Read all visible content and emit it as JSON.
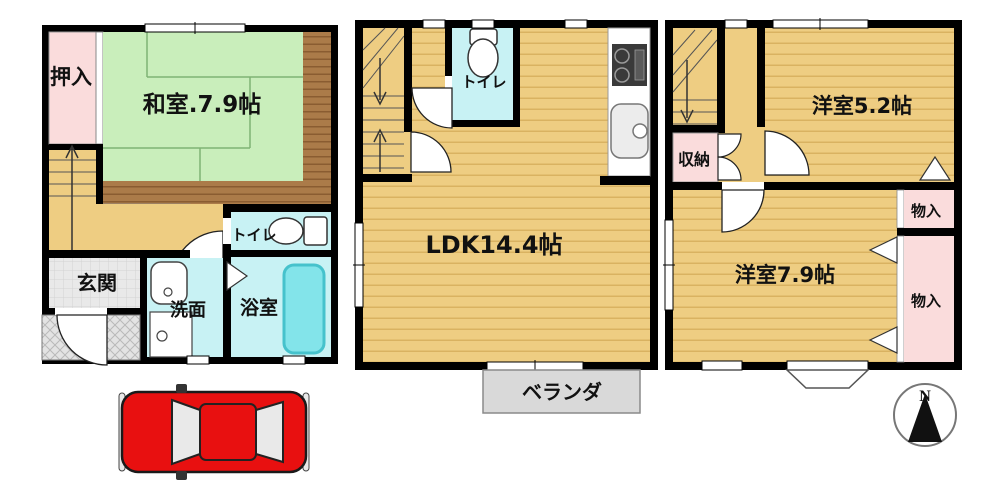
{
  "labels": {
    "f1": {
      "oshiire": "押入",
      "washitsu": "和室.7.9帖",
      "toilet": "トイレ",
      "genkan": "玄関",
      "senmen": "洗面",
      "bath": "浴室"
    },
    "f2": {
      "toilet": "トイレ",
      "ldk": "LDK14.4帖",
      "veranda": "ベランダ"
    },
    "f3": {
      "storage": "収納",
      "western52": "洋室5.2帖",
      "monoireTop": "物入",
      "western79": "洋室7.9帖",
      "monoireBottom": "物入"
    },
    "compass": {
      "north": "N"
    }
  },
  "colors": {
    "wall": "#000000",
    "tatami_green": "#c9eebb",
    "floor_tan": "#eecd82",
    "floor_stripe": "#d9b261",
    "closet_pink": "#fadcdc",
    "wet_cyan": "#c8f2f4",
    "bathtub_cyan": "#83e4ea",
    "wood_trim": "#ab7b49",
    "entry_gray": "#e9e9e9",
    "veranda_gray": "#d9d9d9",
    "car_red": "#e81010"
  }
}
